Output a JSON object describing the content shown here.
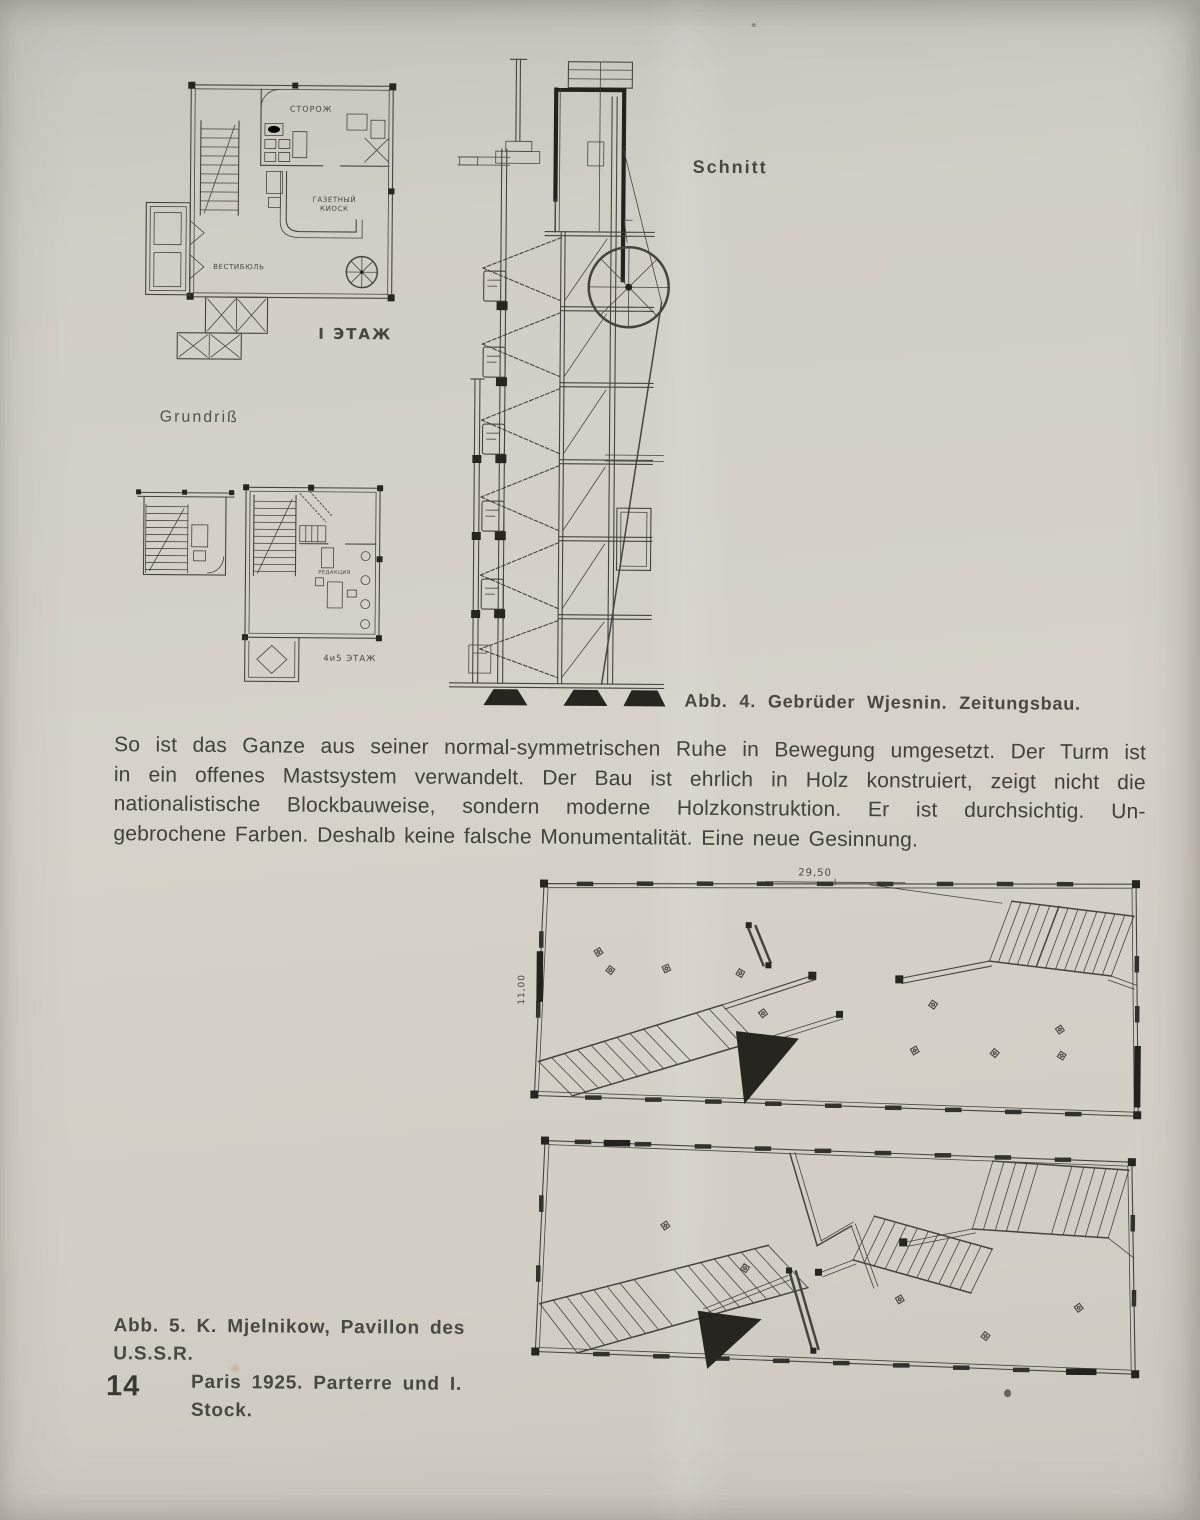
{
  "page": {
    "number": "14"
  },
  "figure4": {
    "grundriss_label": "Grundriß",
    "schnitt_label": "Schnitt",
    "caption": "Abb. 4. Gebrüder Wjesnin. Zeitungsbau.",
    "plan_floor1": {
      "room_guard": "СТОРОЖ",
      "room_kiosk_line1": "ГАЗЕТНЫЙ",
      "room_kiosk_line2": "КИОСК",
      "room_vestibule": "ВЕСТИБЮЛЬ",
      "floor_label": "I ЭТАЖ"
    },
    "plan_floor45": {
      "room_editorial": "РЕДАКЦИЯ",
      "floor_label": "4и5 ЭТАЖ"
    }
  },
  "paragraph": {
    "lines": [
      "So ist das Ganze aus seiner normal-symmetrischen Ruhe in Bewegung umgesetzt. Der Turm ist",
      "in ein offenes Mastsystem verwandelt. Der Bau ist ehrlich in Holz konstruiert, zeigt nicht die",
      "nationalistische Blockbauweise, sondern moderne Holzkonstruktion. Er ist durchsichtig. Un-",
      "gebrochene Farben. Deshalb keine falsche Monumentalität. Eine neue Gesinnung."
    ]
  },
  "figure5": {
    "dim_width": "29,50",
    "dim_height": "11,00",
    "caption_line1": "Abb. 5. K. Mjelnikow, Pavillon des U.S.S.R.",
    "caption_line2": "Paris 1925. Parterre und I. Stock."
  }
}
